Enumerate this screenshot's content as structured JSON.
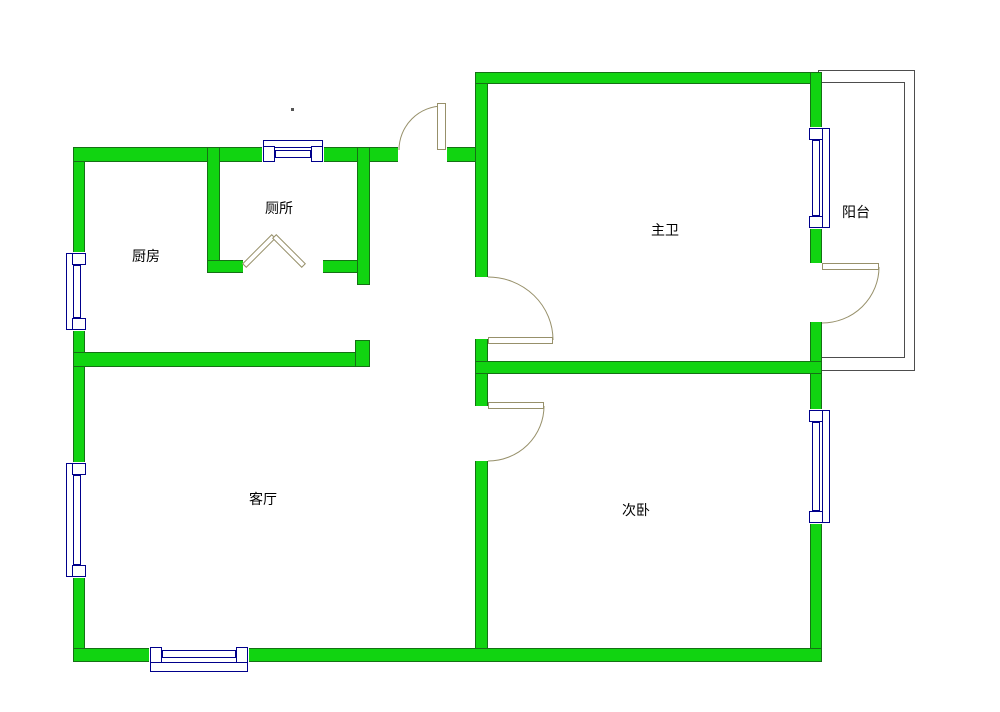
{
  "meta": {
    "type": "residential floor plan"
  },
  "colors": {
    "background": "#ffffff",
    "wall_fill": "#11d411",
    "wall_edge": "#157015",
    "window_line": "#00008b",
    "door_line": "#97906a",
    "balcony_line": "#4d4d4d",
    "text": "#000000"
  },
  "rooms": [
    {
      "id": "kitchen",
      "label": "厨房"
    },
    {
      "id": "toilet",
      "label": "厕所"
    },
    {
      "id": "master-room",
      "label": "主卫"
    },
    {
      "id": "balcony",
      "label": "阳台"
    },
    {
      "id": "living-room",
      "label": "客厅"
    },
    {
      "id": "second-bedroom",
      "label": "次卧"
    }
  ],
  "features": {
    "doors": [
      {
        "id": "entrance-door"
      },
      {
        "id": "toilet-folding-door"
      },
      {
        "id": "master-room-door"
      },
      {
        "id": "second-bedroom-door"
      },
      {
        "id": "balcony-door"
      }
    ],
    "windows": [
      {
        "id": "north-window"
      },
      {
        "id": "kitchen-west-window"
      },
      {
        "id": "living-room-west-window"
      },
      {
        "id": "living-room-south-window"
      },
      {
        "id": "master-room-east-window"
      },
      {
        "id": "second-bedroom-east-window"
      }
    ]
  }
}
